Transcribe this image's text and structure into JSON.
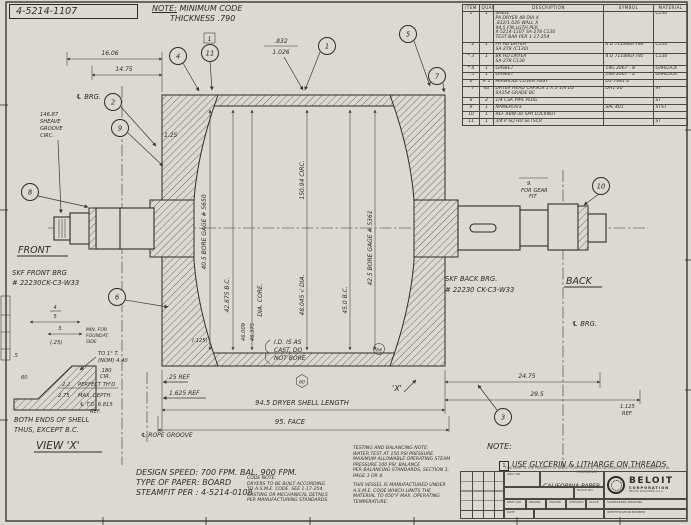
{
  "colors": {
    "paper": "#dcd9d1",
    "ink": "#2e2c27",
    "dim_line": "#3a3832"
  },
  "sheet": {
    "corner_number": "4-5214-1107",
    "top_note_label": "NOTE:",
    "top_note_rest": "MINIMUM CODE",
    "top_note_2": "THICKNESS .790"
  },
  "parts_table": {
    "headers": {
      "item": "ITEM",
      "quan": "QUAN",
      "desc": "DESCRIPTION",
      "symbol": "SYMBOL",
      "material": "MATERIAL"
    },
    "rows": [
      {
        "flag": "",
        "item": "1",
        "qty": "1",
        "desc": "SHELL\nPA DRYER 48 DIA X\n.832/1.026 WALL X\n94.5 FIN LGTH PER\n4-5214-1107 SA-278 C130\nTEST BAR PER 1-17-254",
        "symbol": "",
        "material": "C130"
      },
      {
        "flag": "*",
        "item": "2",
        "qty": "1",
        "desc": "FR HD DRYER\nSA-278 (C130)",
        "symbol": "4 D 71188GF784",
        "material": "C130"
      },
      {
        "flag": "*",
        "item": "3",
        "qty": "1",
        "desc": "BK HD DRYER\nSA-278 C130",
        "symbol": "4 D 71188GF785",
        "material": "C130"
      },
      {
        "flag": "*",
        "item": "4",
        "qty": "1",
        "desc": "GASKET",
        "symbol": "14G 2067 - 8",
        "material": "GARLOCK"
      },
      {
        "flag": "*",
        "item": "5",
        "qty": "1",
        "desc": "GASKET",
        "symbol": "14G 2067 - 2",
        "material": "GARLOCK"
      },
      {
        "flag": "",
        "item": "6",
        "qty": "# 1",
        "desc": "MANHOLE COVER ASSY",
        "symbol": "D1-7681-2",
        "material": ""
      },
      {
        "flag": "*",
        "item": "7",
        "qty": "40",
        "desc": "DRYER HEAD CAPSCR 1 X 3-1/4 LG\nSA354 GRADE BC",
        "symbol": "DH1-20",
        "material": "ST"
      },
      {
        "flag": "",
        "item": "8",
        "qty": "2",
        "desc": "1/4 CSK PIPE PLUG",
        "symbol": "",
        "material": "ST"
      },
      {
        "flag": "",
        "item": "9",
        "qty": "1",
        "desc": "NAMEPLATE",
        "symbol": "SPL 401",
        "material": "STST"
      },
      {
        "flag": "",
        "item": "10",
        "qty": "1",
        "desc": "REF RBW-30 SPR LOCKNUT",
        "symbol": "",
        "material": ""
      },
      {
        "flag": "",
        "item": "11",
        "qty": "1",
        "desc": "3/4 P SQ HD SETSCR",
        "symbol": "",
        "material": "ST"
      }
    ]
  },
  "drawing": {
    "balloons": {
      "b1": "1",
      "b2": "2",
      "b3": "3",
      "b4": "4",
      "b5": "5",
      "b6": "6",
      "b7": "7",
      "b8": "8",
      "b9": "9",
      "b10": "10",
      "b11": "11",
      "flag": "1"
    },
    "dims": {
      "w1606": "16.06",
      "w1475": "14.75",
      "wall_top": ".832",
      "wall_bot": "1.026",
      "d125": "1.25",
      "p125": "(.125)",
      "sheave1": "146.87",
      "sheave2": "SHEAVE",
      "sheave3": "GROOVE",
      "sheave4": "CIRC.",
      "bore_front": "40.5 BORE GAGE # 5650",
      "bc_front": "42.875 B.C.",
      "core_label": "DIA. CORE.",
      "core_hi": "46.009",
      "core_lo": "46.375",
      "circ": "150.94 CIRC.",
      "dia": "48.045 √ DIA.",
      "bc_back": "45.0 B.C.",
      "bore_back": "42.5 BORE GAGE # 5361",
      "ref25": ".25 REF",
      "ref1625": "1.625 REF",
      "shell_len": "94.5 DRYER SHELL LENGTH",
      "face": "95. FACE",
      "rope": "℄ ROPE GROOVE",
      "d2475": "24.75",
      "d295": "29.5",
      "ref1125a": "1.125",
      "ref1125b": "REF.",
      "gear9": "9.",
      "gear_a": "FOR GEAR",
      "gear_b": "FIT",
      "cast1": "I.D. IS AS",
      "cast2": "CAST, DO",
      "cast3": "NOT BORE",
      "hex60": "60",
      "fin64": "64",
      "xmark": "'X'"
    },
    "labels": {
      "clbrg": "℄ BRG.",
      "front": "FRONT",
      "front_brg1": "SKF FRONT BRG",
      "front_brg2": "# 22230CK-C3-W33",
      "back_brg1": "SKF BACK BRG.",
      "back_brg2": "# 22230 CK-C3-W33",
      "back": "BACK",
      "clbrg2": "℄ BRG."
    }
  },
  "view_x": {
    "title": "VIEW 'X'",
    "cap1": "BOTH ENDS OF SHELL",
    "cap2": "THUS, EXCEPT B.C.",
    "f_top": "4",
    "f_bot": "5",
    "d3": "3.",
    "min1": "MIN. FOR",
    "min2": "FOUNDAT.",
    "min3": "SIDE",
    "p25": "(.25)",
    "p5": ".5",
    "a60": "60",
    "taper1": "TO 1° T.",
    "taper2": "(NOM) 4.40",
    "cir1": ".180",
    "cir2": "CIR.",
    "d22": "2.2",
    "perfect": "PERFECT TH'D",
    "d275": "2.75",
    "maxd": "MAX. DEPTH",
    "td": "℄ T.D. 6.815",
    "tdref": "REF."
  },
  "notes": {
    "testing": "TESTING AND BALANCING NOTE:\nWATER TEST AT 150 PSI PRESSURE.\nMAXIMUM ALLOWABLE OPERATING STEAM\nPRESSURE 100 PSI. BALANCE\nPER BALANCING STANDARDS, SECTION 3,\nPAGE 3 OR 4.",
    "vessel": "THIS VESSEL IS MANUFACTURED UNDER\nA.S.M.E. CODE WHICH LIMITS THE\nMATERIAL TO 650°F MAX. OPERATING\nTEMPERATURE.",
    "code": "CODE NOTE:\nDRYERS TO BE BUILT ACCORDING\nTO A.S.M.E. CODE. SEE 1-17-254.\nCASTING OR MECHANICAL DETAILS\nPER MANUFACTURING STANDARDS.",
    "spec1": "DESIGN SPEED: 700 FPM.  BAL. 900 FPM.",
    "spec2": "TYPE OF PAPER: BOARD",
    "spec3": "STEAMFIT PER : 4-5214-0108",
    "note_label": "NOTE:",
    "note_flag": "1",
    "note_text": "USE GLYCERIN & LITHARGE ON THREADS",
    "property": "THIS PRINT IS THE PROPERTY OF BELOIT CORPORATION. THE INFORMATION THEREON IS SUBMITTED IN CONFIDENCE"
  },
  "title_block": {
    "labels": {
      "ord": "ORD. NO.",
      "block": "BLOCK NO.",
      "dept": "DEPT. NO.",
      "drawn": "DRAWN",
      "traced": "TRACED",
      "checked": "CHECKED",
      "scale": "SCALE",
      "supersedes": "SUPERSEDES DRAWING",
      "date": "DATE",
      "ident": "IDENTIFICATION NUMBER"
    },
    "order_no": "38243",
    "customer": "CALIFORNIA PAPER",
    "location": "SANTA CLARA CALIF",
    "block_no": "7",
    "dept_no": "642",
    "drawn": "WDW",
    "traced": "R.R.",
    "checked": "SYP",
    "scale": "",
    "supersedes": "MD-1034-7",
    "date": "8-5-74",
    "title": "48 DIA PAPER DRYER",
    "number": "4-5214-1107",
    "company": "BELOIT",
    "company2": "CORPORATION",
    "company3": "BELOIT, WISCONSIN U.S.A."
  }
}
